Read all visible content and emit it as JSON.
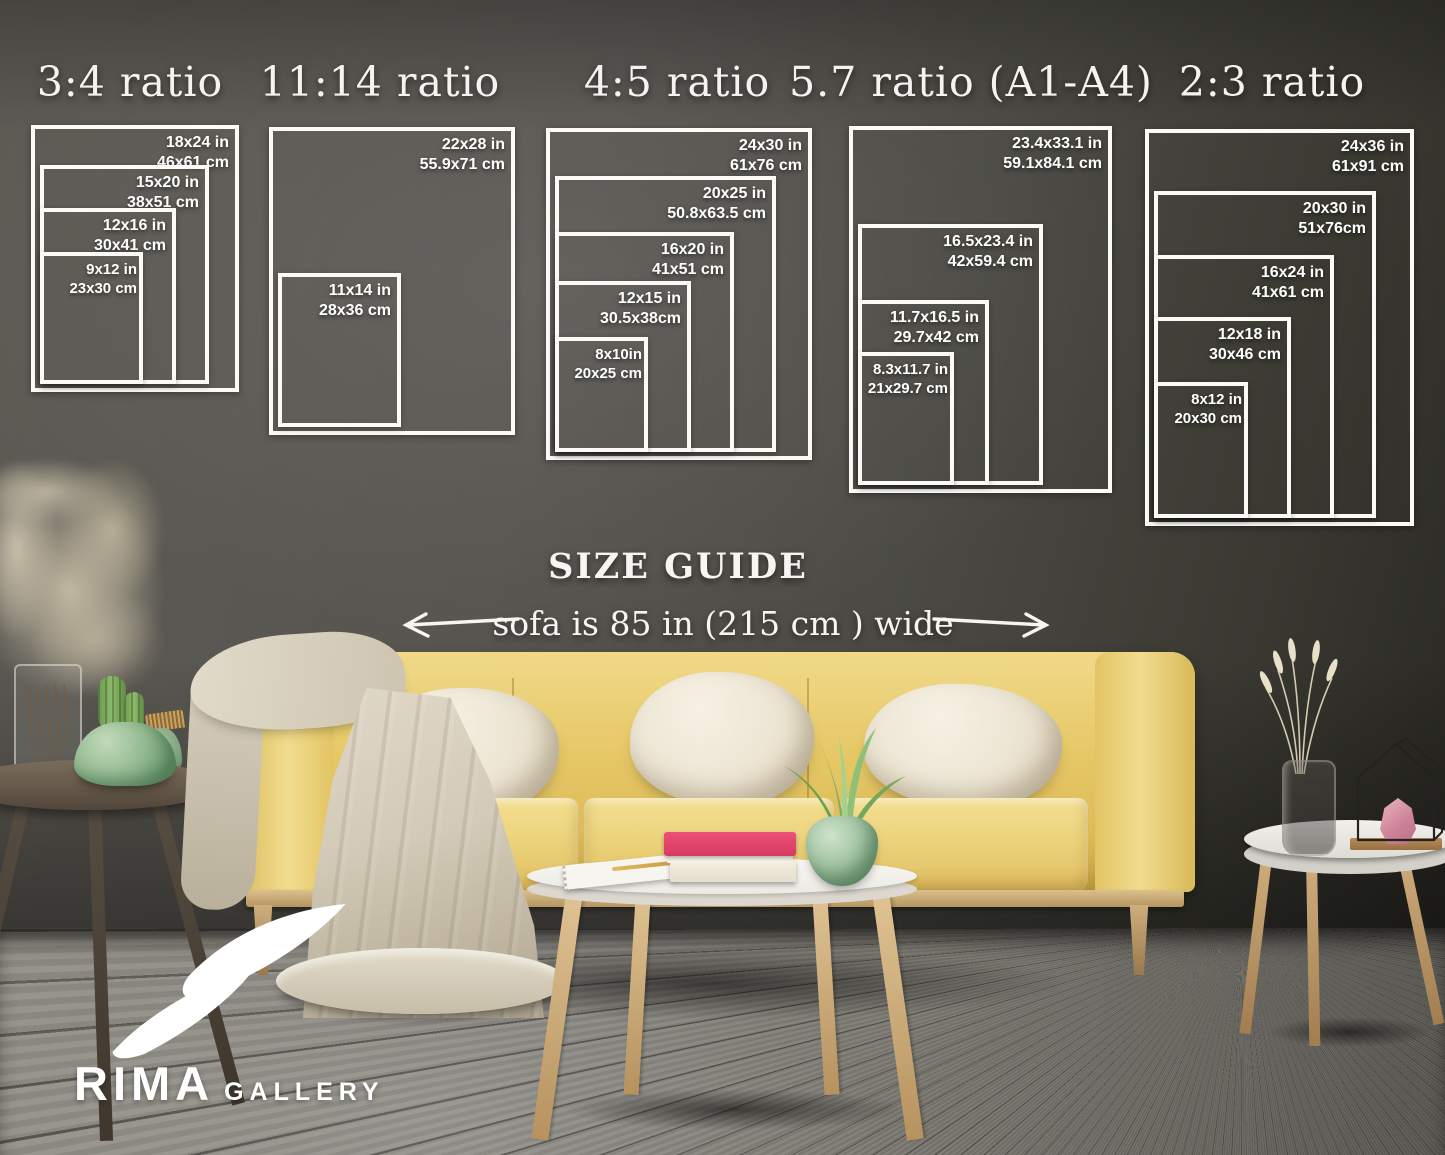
{
  "size_guide": {
    "title": "SIZE GUIDE",
    "sofa_note": "sofa is 85 in (215 cm ) wide",
    "groups": [
      {
        "label": "3:4 ratio",
        "sizes": [
          {
            "inches": "18x24 in",
            "cm": "46x61 cm"
          },
          {
            "inches": "15x20 in",
            "cm": "38x51 cm"
          },
          {
            "inches": "12x16 in",
            "cm": "30x41 cm"
          },
          {
            "inches": "9x12 in",
            "cm": "23x30 cm"
          }
        ]
      },
      {
        "label": "11:14 ratio",
        "sizes": [
          {
            "inches": "22x28 in",
            "cm": "55.9x71 cm"
          },
          {
            "inches": "11x14 in",
            "cm": "28x36 cm"
          }
        ]
      },
      {
        "label": "4:5 ratio",
        "sizes": [
          {
            "inches": "24x30 in",
            "cm": "61x76 cm"
          },
          {
            "inches": "20x25 in",
            "cm": "50.8x63.5 cm"
          },
          {
            "inches": "16x20 in",
            "cm": "41x51 cm"
          },
          {
            "inches": "12x15 in",
            "cm": "30.5x38cm"
          },
          {
            "inches": "8x10in",
            "cm": "20x25 cm"
          }
        ]
      },
      {
        "label": "5.7 ratio (A1-A4)",
        "sizes": [
          {
            "inches": "23.4x33.1 in",
            "cm": "59.1x84.1 cm"
          },
          {
            "inches": "16.5x23.4 in",
            "cm": "42x59.4 cm"
          },
          {
            "inches": "11.7x16.5 in",
            "cm": "29.7x42 cm"
          },
          {
            "inches": "8.3x11.7 in",
            "cm": "21x29.7 cm"
          }
        ]
      },
      {
        "label": "2:3 ratio",
        "sizes": [
          {
            "inches": "24x36 in",
            "cm": "61x91 cm"
          },
          {
            "inches": "20x30 in",
            "cm": "51x76cm"
          },
          {
            "inches": "16x24 in",
            "cm": "41x61 cm"
          },
          {
            "inches": "12x18 in",
            "cm": "30x46 cm"
          },
          {
            "inches": "8x12 in",
            "cm": "20x30 cm"
          }
        ]
      }
    ]
  },
  "logo": {
    "brand": "RIMA",
    "suffix": "GALLERY"
  },
  "colors": {
    "wall": "#4f4e49",
    "floor": "#7c7a72",
    "sofa_yellow": "#e7c968",
    "pillow_cream": "#ece4d2",
    "book_pink": "#ee5077",
    "vase_green": "#94bb92",
    "frame_white": "#fbfaf7"
  }
}
